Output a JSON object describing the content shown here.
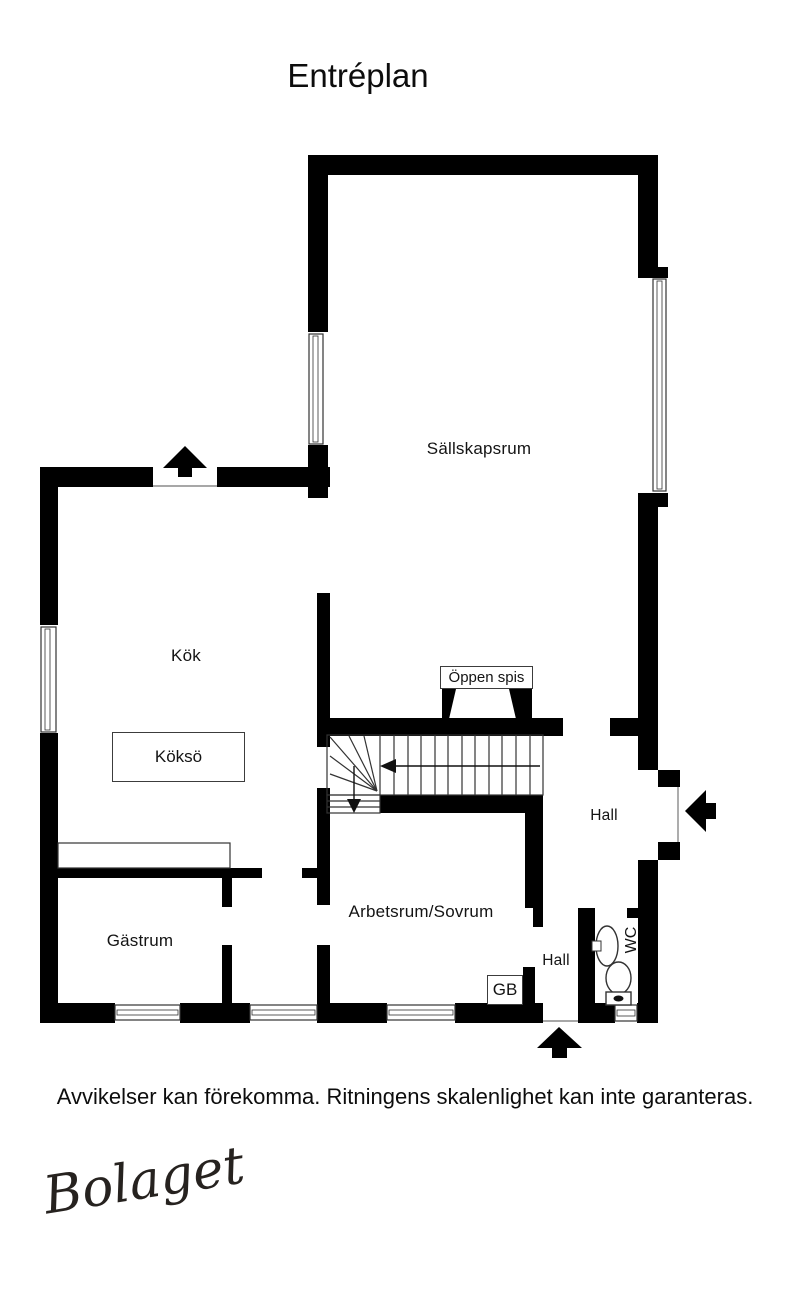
{
  "title": "Entréplan",
  "rooms": {
    "sallskapsrum": "Sällskapsrum",
    "kok": "Kök",
    "kokso": "Köksö",
    "oppen_spis": "Öppen spis",
    "hall_upper": "Hall",
    "arbetsrum": "Arbetsrum/Sovrum",
    "gastrum": "Gästrum",
    "hall_lower": "Hall",
    "gb": "GB",
    "wc": "WC"
  },
  "footer": {
    "disclaimer": "Avvikelser kan förekomma. Ritningens skalenlighet kan inte garanteras.",
    "logo": "Bolaget"
  },
  "colors": {
    "wall": "#000000",
    "background": "#ffffff",
    "thin_line": "#333333"
  }
}
